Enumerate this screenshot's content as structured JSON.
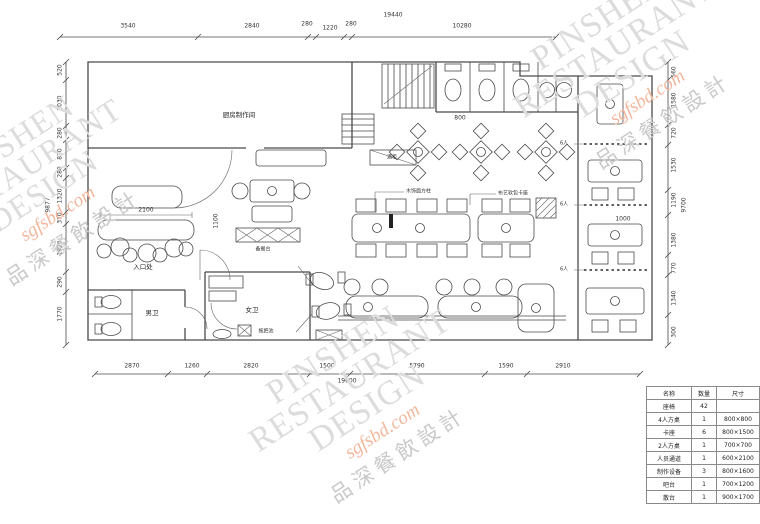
{
  "watermark": {
    "line1": "PINSHEN",
    "line2": "RESTAURANT",
    "line3": "DESIGN",
    "domain": "sgfsbd.com",
    "chinese": "品深餐飲設計"
  },
  "dimensions": {
    "top_total": "19440",
    "top": [
      "3540",
      "2840",
      "280",
      "1220",
      "280",
      "10280"
    ],
    "bottom_total": "19600",
    "bottom": [
      "2870",
      "1260",
      "2820",
      "1500",
      "5790",
      "1590",
      "2910"
    ],
    "left_total": "9877",
    "left": [
      "520",
      "2030",
      "280",
      "820",
      "280",
      "1320",
      "370",
      "1920",
      "290",
      "1770"
    ],
    "right_total": "9700",
    "right": [
      "560",
      "1580",
      "720",
      "1530",
      "1190",
      "1380",
      "770",
      "1340",
      "300"
    ]
  },
  "rooms": {
    "kitchen": "厨房制作间",
    "mens_wc": "男卫",
    "womens_wc": "女卫",
    "entrance": "入口处",
    "mop_sink": "拖把池",
    "prep_counter": "备餐台",
    "wine_cabinet": "酒柜"
  },
  "notes": {
    "column": "木饰面方柱",
    "booth": "布艺软包卡座",
    "booth_seats": "6人"
  },
  "inline_dims": {
    "d2100": "2100",
    "d1100": "1100",
    "d1000": "1000",
    "d800": "800"
  },
  "legend": {
    "headers": [
      "名称",
      "数量",
      "尺寸"
    ],
    "rows": [
      [
        "座椅",
        "42",
        ""
      ],
      [
        "4人方桌",
        "1",
        "800×800"
      ],
      [
        "卡座",
        "6",
        "800×1500"
      ],
      [
        "2人方桌",
        "1",
        "700×700"
      ],
      [
        "人员通道",
        "1",
        "600×2100"
      ],
      [
        "制作设备",
        "3",
        "800×1600"
      ],
      [
        "吧台",
        "1",
        "700×1200"
      ],
      [
        "散台",
        "1",
        "900×1700"
      ]
    ]
  }
}
